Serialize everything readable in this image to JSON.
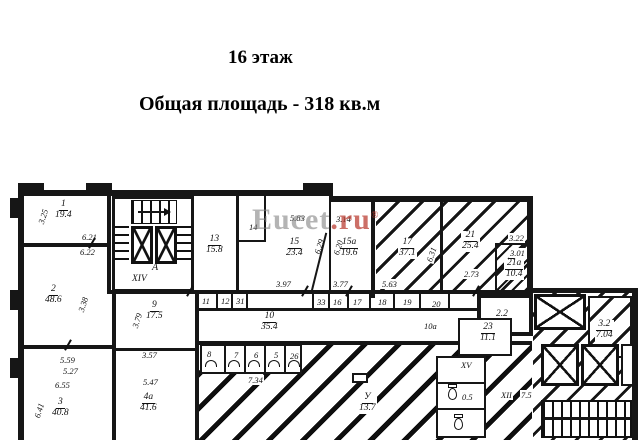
{
  "header": {
    "floor": "16 этаж",
    "total_area": "Общая площадь - 318 кв.м"
  },
  "watermark": {
    "main": "Eucet",
    "suffix": ".ru",
    "reg": "®"
  },
  "plan": {
    "rooms": {
      "r1": {
        "num": "1",
        "area": "19.4"
      },
      "r2": {
        "num": "2",
        "area": "48.6"
      },
      "r3": {
        "num": "3",
        "area": "40.8"
      },
      "r4a": {
        "num": "4а",
        "area": "41.6"
      },
      "r9": {
        "num": "9",
        "area": "17.5"
      },
      "r13": {
        "num": "13",
        "area": "15.8"
      },
      "r15": {
        "num": "15",
        "area": "23.4"
      },
      "r15a": {
        "num": "15а",
        "area": "19.6"
      },
      "r17": {
        "num": "17",
        "area": "37.1"
      },
      "r21": {
        "num": "21",
        "area": "25.4"
      },
      "r21a": {
        "num": "21а",
        "area": "10.4"
      },
      "r23": {
        "num": "23",
        "area": "11.1"
      },
      "r10": {
        "num": "10",
        "area": "35.4"
      },
      "r32": {
        "num": "3.2",
        "area": "7.04"
      },
      "hall": {
        "num": "У",
        "area": "13.7"
      }
    },
    "small": {
      "s11": "11",
      "s12": "12",
      "s31": "31",
      "s33": "33",
      "s16": "16",
      "s17": "17",
      "s18": "18",
      "s19": "19",
      "s20": "20",
      "s14": "14",
      "s8": "8",
      "s7": "7",
      "s6": "6",
      "s5": "5",
      "s26": "26",
      "s22": "2.2",
      "s10a": "10а",
      "core_room": "А",
      "core_num": "XIV",
      "wc_num": "XV",
      "wc_area": "0.5",
      "stair_num": "XII",
      "stair_area": "7.5"
    },
    "dims": {
      "d325": "3.25",
      "d621": "6.21",
      "d622": "6.22",
      "d338": "3.38",
      "d559": "5.59",
      "d527": "5.27",
      "d655": "6.55",
      "d641": "6.41",
      "d379": "3.79",
      "d357": "3.57",
      "d547": "5.47",
      "d583": "5.83",
      "d314": "3.14",
      "d629": "6.29",
      "d620": "6.20",
      "d397": "3.97",
      "d377": "3.77",
      "d563": "5.63",
      "d631": "6.31",
      "d273": "2.73",
      "d322": "3.22",
      "d301": "3.01",
      "d734": "7.34"
    }
  }
}
